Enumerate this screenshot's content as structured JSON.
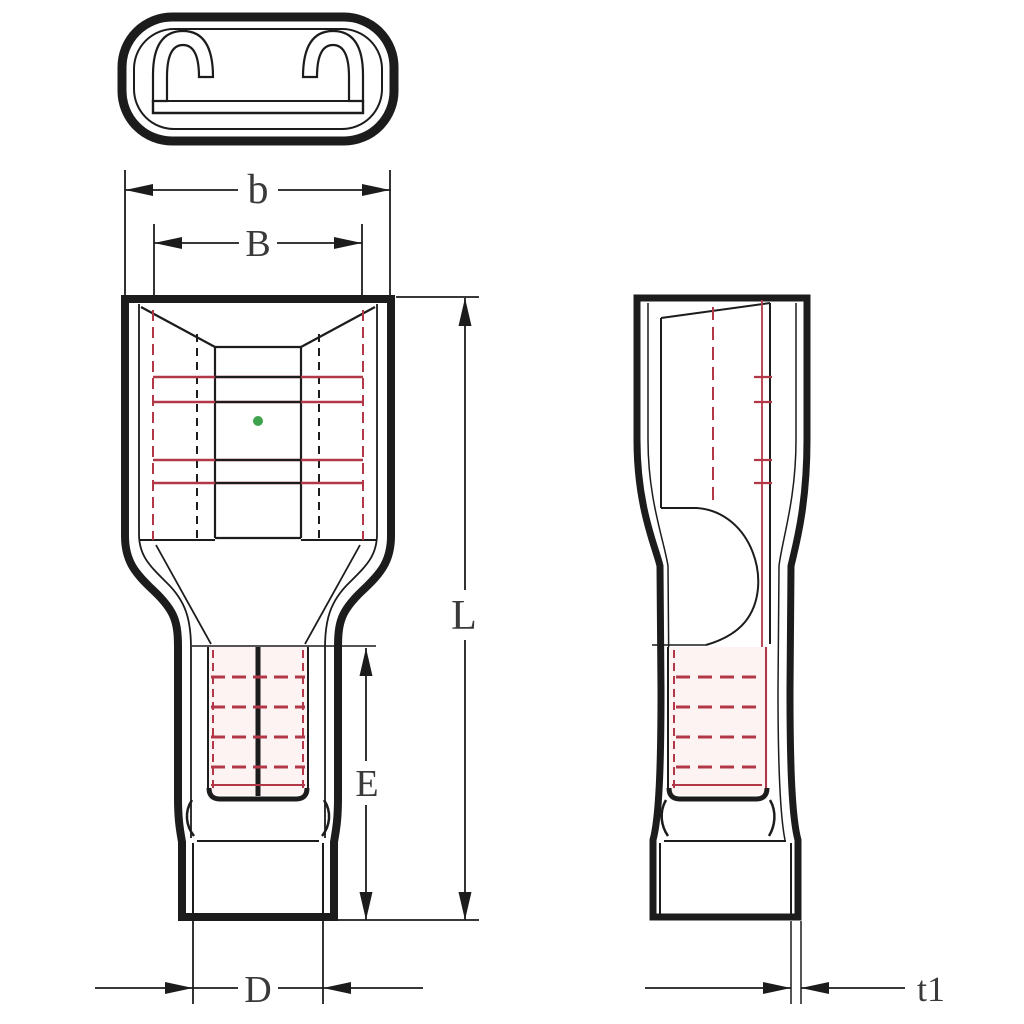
{
  "labels": {
    "b": "b",
    "B": "B",
    "L": "L",
    "E": "E",
    "D": "D",
    "t1": "t1"
  },
  "colors": {
    "background": "#ffffff",
    "line": "#1c1c1c",
    "red": "#b23848",
    "redlight": "#d98f98",
    "pink_wash": "#fdf3f3",
    "green": "#3fa34d",
    "label": "#3a3a3a"
  }
}
